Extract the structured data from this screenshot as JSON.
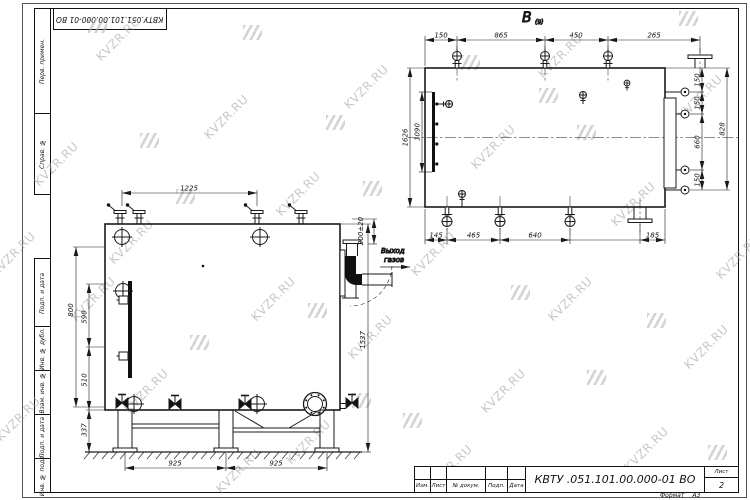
{
  "watermark": {
    "text": "KVZR.RU",
    "color": "#aaaaaa"
  },
  "frame": {
    "top_stamp": "КВТУ.051.101.00.000-01 ВО",
    "side_fields": [
      "Перв. примен.",
      "Справ. №",
      "Подп. и дата",
      "Инв. № дубл.",
      "Взам. инв. №",
      "Подп. и дата",
      "Инв. № подл."
    ]
  },
  "title_block": {
    "doc_number": "КВТУ .051.101.00.000-01  ВО",
    "columns": [
      "Изм.",
      "Лист",
      "№ докум.",
      "Подп.",
      "Дата"
    ],
    "sheet_label": "Лист",
    "sheet_number": "2",
    "format_label": "Формат",
    "format_value": "А3"
  },
  "top_view": {
    "label": "В",
    "label_sub": "(9)",
    "dims": {
      "top": [
        "150",
        "865",
        "450",
        "265"
      ],
      "right_chain": [
        "150",
        "150",
        "660",
        "150"
      ],
      "right_outer": "828",
      "left_outer": "1626",
      "left_inner": "1090",
      "bottom": [
        "145",
        "465",
        "640",
        "185"
      ]
    }
  },
  "front_view": {
    "outlet_label": [
      "Выход",
      "газов"
    ],
    "dims": {
      "top": "1225",
      "left_outer": "800",
      "left": [
        "590",
        "510"
      ],
      "leg_height": "337",
      "right": "1537",
      "outlet": "200±20",
      "bottom": [
        "925",
        "925"
      ]
    }
  }
}
